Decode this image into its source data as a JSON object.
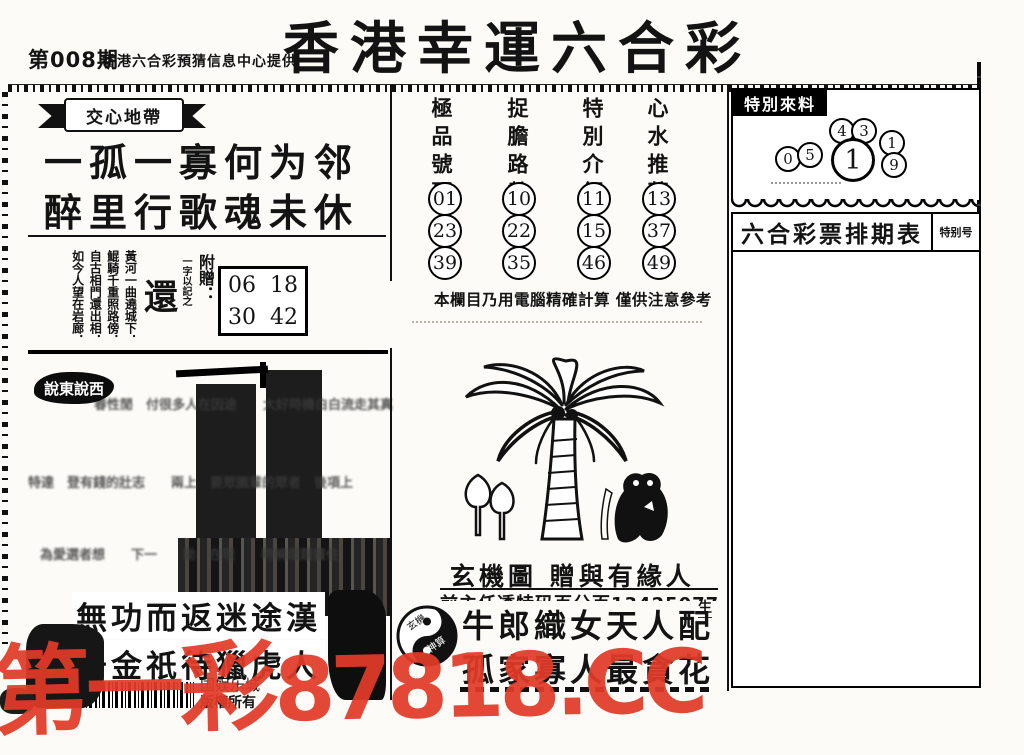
{
  "header": {
    "issue": "第008期",
    "provider": "香港六合彩預猜信息中心提供",
    "title": "香港幸運六合彩"
  },
  "left": {
    "banner": "交心地帶",
    "poem_line1": "一孤一寡何为邻",
    "poem_line2": "醉里行歌魂未休",
    "verse_columns": [
      "黃河一曲遶城下．",
      "鯤騎千重照路傍．",
      "自古相門還出相．",
      "如今人望在岩廊．"
    ],
    "seal_label": "一字以記之",
    "seal_char": "還",
    "bonus_label": "附贈：",
    "bonus_numbers": [
      [
        "06",
        "18"
      ],
      [
        "30",
        "42"
      ]
    ],
    "gossip_label": "說東說西",
    "fuzzy_line1": "春性閒　付很多人在因途　　大好時機白白流走其真",
    "fuzzy_line2": "特達　登有錢的壯志　　兩上　要眾園輩的眾者　後項上",
    "fuzzy_line3": "為愛選者想　　下一　　動　在現　　時曉環題畫住",
    "bottom_line1": "無功而返迷途漢",
    "bottom_line2": "千金祇待獵虎人",
    "footer_company": "国娱乐城",
    "footer_rights": "版權所有"
  },
  "picks": {
    "columns": [
      {
        "title": "極品號碼",
        "numbers": [
          "01",
          "23",
          "39"
        ]
      },
      {
        "title": "捉膽路數",
        "numbers": [
          "10",
          "22",
          "35"
        ]
      },
      {
        "title": "特別介紹",
        "numbers": [
          "11",
          "15",
          "46"
        ]
      },
      {
        "title": "心水推薦",
        "numbers": [
          "13",
          "37",
          "49"
        ]
      }
    ],
    "note": "本欄目乃用電腦精確計算 僅供注意參考"
  },
  "mystery": {
    "caption": "玄機圖 贈與有緣人",
    "subline": "前主任透特码百分百13425077070",
    "side_char": "生",
    "yinyang_top": "玄機",
    "yinyang_bottom": "神算",
    "couplet_line1": "牛郎織女天人配",
    "couplet_line2": "孤家寡人最貪花"
  },
  "special": {
    "title": "特別來料",
    "digit_l1": "0",
    "digit_l2": "5",
    "digit_t1": "4",
    "digit_t2": "3",
    "digit_main": "1",
    "digit_r1": "1",
    "digit_r2": "9"
  },
  "schedule": {
    "title": "六合彩票排期表",
    "corner_label": "特别号"
  },
  "watermark": {
    "text_cn": "第一彩",
    "text_code": "87818.CC",
    "color": "#e23b28"
  }
}
